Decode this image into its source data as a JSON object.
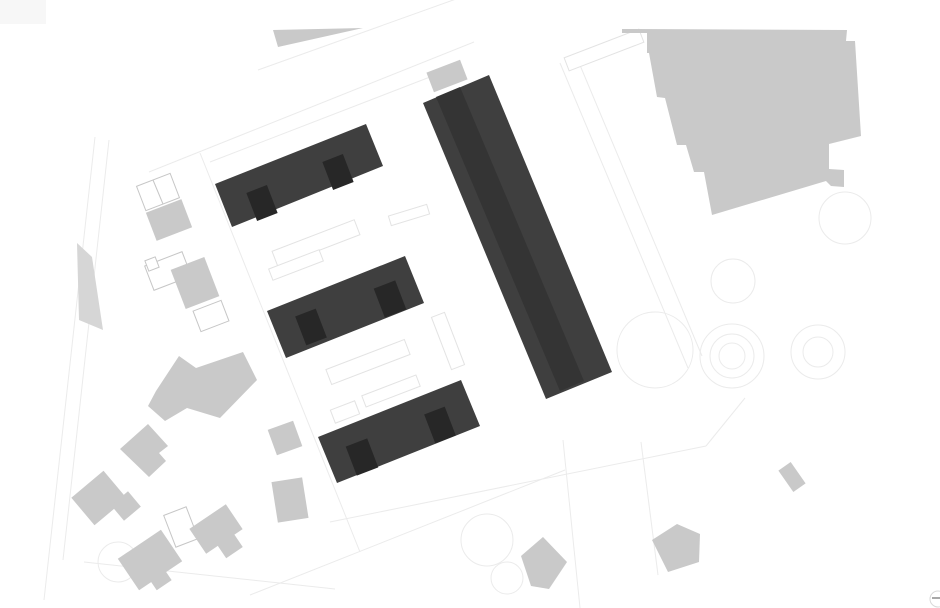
{
  "canvas": {
    "width": 940,
    "height": 608,
    "background": "#ffffff"
  },
  "palette": {
    "proposed_building_fill": "#3f3f3f",
    "proposed_core_fill": "#272727",
    "roof_stripe_fill": "#343434",
    "context_building_fill": "#c9c9c9",
    "context_building_alt_fill": "#d6d6d6",
    "corner_patch_fill": "#f7f7f7",
    "faint_line_stroke": "#ebebeb",
    "wing_outline_stroke": "#e3e3e3",
    "parcel_outline_stroke": "#c6c6c6",
    "control_ring_stroke": "#d9d9d9",
    "control_dash_stroke": "#8a8a8a"
  },
  "layers": {
    "corner_patch": {
      "x": 0,
      "y": 0,
      "w": 46,
      "h": 24
    },
    "faint_lines": [
      {
        "x1": 149,
        "y1": 172,
        "x2": 474,
        "y2": 42
      },
      {
        "x1": 258,
        "y1": 70,
        "x2": 470,
        "y2": -6
      },
      {
        "x1": 210,
        "y1": 162,
        "x2": 430,
        "y2": 77
      },
      {
        "x1": 200,
        "y1": 153,
        "x2": 360,
        "y2": 552
      },
      {
        "x1": 250,
        "y1": 595,
        "x2": 565,
        "y2": 470
      },
      {
        "x1": 95,
        "y1": 137,
        "x2": 44,
        "y2": 600
      },
      {
        "x1": 109,
        "y1": 140,
        "x2": 63,
        "y2": 560
      },
      {
        "x1": 560,
        "y1": 63,
        "x2": 688,
        "y2": 368
      },
      {
        "x1": 577,
        "y1": 58,
        "x2": 702,
        "y2": 356
      },
      {
        "x1": 330,
        "y1": 522,
        "x2": 706,
        "y2": 446
      },
      {
        "x1": 706,
        "y1": 446,
        "x2": 745,
        "y2": 398
      },
      {
        "x1": 563,
        "y1": 440,
        "x2": 580,
        "y2": 608
      },
      {
        "x1": 641,
        "y1": 442,
        "x2": 658,
        "y2": 575
      },
      {
        "x1": 84,
        "y1": 562,
        "x2": 335,
        "y2": 589
      }
    ],
    "faint_circles": [
      {
        "cx": 732,
        "cy": 356,
        "r": 32
      },
      {
        "cx": 732,
        "cy": 356,
        "r": 22
      },
      {
        "cx": 732,
        "cy": 356,
        "r": 13
      },
      {
        "cx": 818,
        "cy": 352,
        "r": 27
      },
      {
        "cx": 818,
        "cy": 352,
        "r": 15
      },
      {
        "cx": 733,
        "cy": 281,
        "r": 22
      },
      {
        "cx": 845,
        "cy": 218,
        "r": 26
      },
      {
        "cx": 655,
        "cy": 350,
        "r": 38
      },
      {
        "cx": 487,
        "cy": 540,
        "r": 26
      },
      {
        "cx": 507,
        "cy": 578,
        "r": 16
      },
      {
        "cx": 118,
        "cy": 562,
        "r": 20
      }
    ],
    "wing_outline_rects": [
      {
        "cx": 409,
        "cy": 215,
        "w": 40,
        "h": 10,
        "a": -17
      },
      {
        "cx": 316,
        "cy": 243,
        "w": 88,
        "h": 16,
        "a": -21
      },
      {
        "cx": 296,
        "cy": 265,
        "w": 54,
        "h": 12,
        "a": -21
      },
      {
        "cx": 368,
        "cy": 362,
        "w": 84,
        "h": 16,
        "a": -21
      },
      {
        "cx": 391,
        "cy": 391,
        "w": 58,
        "h": 12,
        "a": -21
      },
      {
        "cx": 345,
        "cy": 412,
        "w": 26,
        "h": 14,
        "a": -21
      },
      {
        "cx": 448,
        "cy": 341,
        "w": 14,
        "h": 56,
        "a": -21
      },
      {
        "cx": 604,
        "cy": 50,
        "w": 80,
        "h": 14,
        "a": -21
      }
    ],
    "parcel_outline_rects": [
      {
        "cx": 158,
        "cy": 192,
        "w": 36,
        "h": 26,
        "a": -21
      },
      {
        "cx": 168,
        "cy": 271,
        "w": 40,
        "h": 26,
        "a": -21
      },
      {
        "cx": 152,
        "cy": 264,
        "w": 11,
        "h": 11,
        "a": -21
      },
      {
        "cx": 181,
        "cy": 527,
        "w": 24,
        "h": 34,
        "a": -21
      },
      {
        "cx": 211,
        "cy": 316,
        "w": 30,
        "h": 22,
        "a": -21
      }
    ],
    "parcel_outline_lines": [
      {
        "x1": 153,
        "y1": 180,
        "x2": 163,
        "y2": 204
      }
    ],
    "context_polygons": [
      {
        "points": "622,29 847,30 846,41 855,41 861,136 829,144 829,169 844,170 844,187 831,186 826,181 712,215 704,172 694,172 686,145 677,145 665,98 657,97 649,53 647,53 647,33 622,33"
      },
      {
        "points": "273,30 363,28 278,47"
      },
      {
        "points": "156,391 179,356 196,368 243,352 257,380 220,418 187,408 165,421 148,406"
      },
      {
        "points": "120,449 148,424 168,446 159,453 166,461 149,477"
      },
      {
        "points": "521,556 543,537 567,562 549,589 531,586"
      },
      {
        "points": "652,540 677,524 700,534 699,562 668,572"
      }
    ],
    "context_polygons_alt": [
      {
        "points": "77,243 92,257 103,330 79,320"
      }
    ],
    "context_rects": [
      {
        "cx": 169,
        "cy": 220,
        "w": 38,
        "h": 30,
        "a": -21
      },
      {
        "cx": 195,
        "cy": 283,
        "w": 36,
        "h": 42,
        "a": -21
      },
      {
        "cx": 447,
        "cy": 76,
        "w": 36,
        "h": 21,
        "a": -21
      },
      {
        "cx": 285,
        "cy": 438,
        "w": 27,
        "h": 27,
        "a": -20
      },
      {
        "cx": 290,
        "cy": 500,
        "w": 31,
        "h": 41,
        "a": -9
      },
      {
        "cx": 99,
        "cy": 498,
        "w": 42,
        "h": 36,
        "a": -40
      },
      {
        "cx": 126,
        "cy": 506,
        "w": 22,
        "h": 20,
        "a": -40
      },
      {
        "cx": 150,
        "cy": 560,
        "w": 52,
        "h": 38,
        "a": -34
      },
      {
        "cx": 160,
        "cy": 579,
        "w": 18,
        "h": 15,
        "a": -34
      },
      {
        "cx": 216,
        "cy": 529,
        "w": 44,
        "h": 30,
        "a": -34
      },
      {
        "cx": 230,
        "cy": 546,
        "w": 20,
        "h": 16,
        "a": -34
      },
      {
        "cx": 792,
        "cy": 477,
        "w": 15,
        "h": 26,
        "a": -35
      }
    ],
    "proposed_bars": [
      {
        "points": "215,184 366,124 383,166 232,227"
      },
      {
        "points": "267,311 405,256 424,303 286,358"
      },
      {
        "points": "318,437 461,380 480,426 337,483"
      },
      {
        "points": "423,103 489,75 612,372 546,399"
      }
    ],
    "roof_stripe": {
      "points": "436,97 460,87 584,381 560,391"
    },
    "proposed_cores": [
      {
        "cx": 262,
        "cy": 203,
        "w": 22,
        "h": 30,
        "a": -21
      },
      {
        "cx": 338,
        "cy": 172,
        "w": 22,
        "h": 30,
        "a": -21
      },
      {
        "cx": 311,
        "cy": 327,
        "w": 22,
        "h": 31,
        "a": -21
      },
      {
        "cx": 390,
        "cy": 299,
        "w": 23,
        "h": 31,
        "a": -21
      },
      {
        "cx": 362,
        "cy": 457,
        "w": 23,
        "h": 31,
        "a": -21
      },
      {
        "cx": 440,
        "cy": 425,
        "w": 22,
        "h": 31,
        "a": -21
      }
    ],
    "zoom_control": {
      "cx": 938,
      "cy": 599,
      "r": 8,
      "dash_x1": 932,
      "dash_y1": 598,
      "dash_x2": 942,
      "dash_y2": 598
    }
  }
}
